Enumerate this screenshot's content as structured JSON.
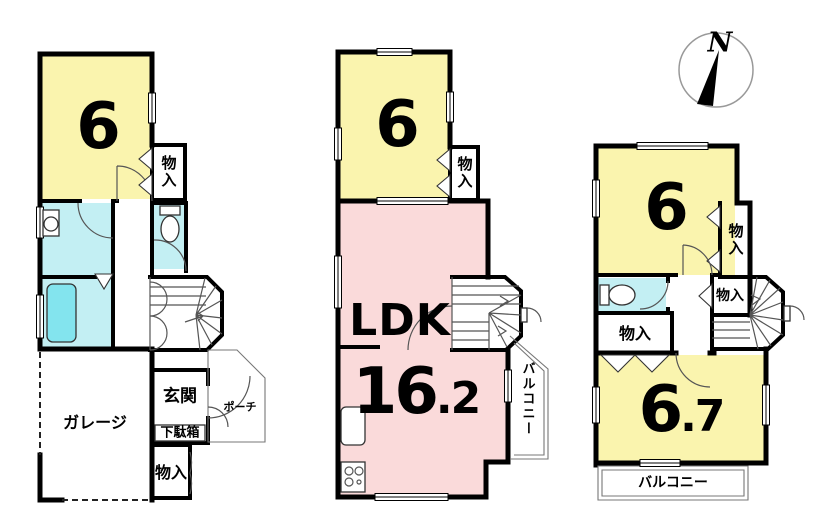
{
  "compass": {
    "north_label": "N"
  },
  "colors": {
    "room_yellow": "#faf4ae",
    "room_pink": "#fadada",
    "wet_cyan": "#c3eff3",
    "bathtub_cyan": "#83e4ee",
    "wall_black": "#000000"
  },
  "floor1": {
    "room6_size": "6",
    "closet_upper": "物入",
    "entrance": "玄関",
    "shoe_cabinet": "下駄箱",
    "porch": "ポーチ",
    "garage": "ガレージ",
    "closet_lower": "物入"
  },
  "floor2": {
    "room6_size": "6",
    "closet": "物入",
    "ldk_label": "LDK",
    "ldk_size_whole": "16",
    "ldk_size_decimal": ".2",
    "balcony": "バルコニー"
  },
  "floor3": {
    "room6_size": "6",
    "closet_right": "物入",
    "closet_middle": "物入",
    "closet_left": "物入",
    "room67_size_whole": "6",
    "room67_size_decimal": ".7",
    "balcony": "バルコニー"
  }
}
